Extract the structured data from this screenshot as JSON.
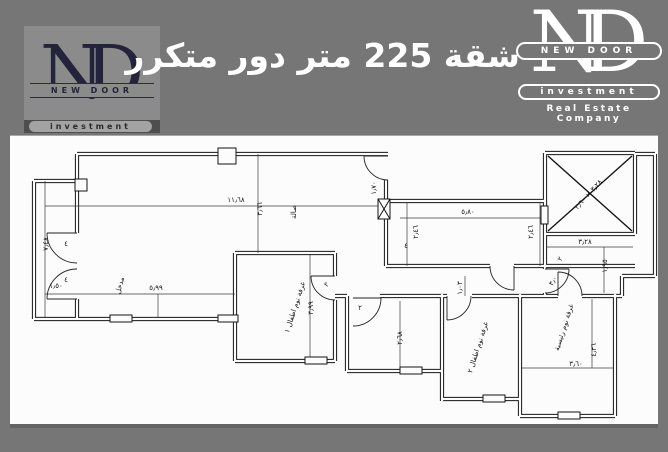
{
  "header": {
    "title": "شقة 225 متر دور متكرر"
  },
  "logo_left": {
    "monogram_n": "N",
    "monogram_d": "D",
    "band": "NEW DOOR",
    "pill": "investment"
  },
  "logo_right": {
    "monogram_n": "N",
    "monogram_d": "D",
    "band": "NEW DOOR",
    "pill": "investment",
    "tagline": "Real Estate Company"
  },
  "colors": {
    "background": "#767676",
    "panel": "#fcfcfc",
    "logo_left_box": "#8b8b8b",
    "logo_left_ink": "#23233b",
    "logo_left_dark_band": "#4e4e4e",
    "logo_right_ink": "#ffffff",
    "plan_line": "#151515",
    "title_text": "#ffffff"
  },
  "plan": {
    "annotations": [
      {
        "text": "١١٫٦٨",
        "x": 226,
        "y": 66,
        "rot": 0
      },
      {
        "text": "٣٫٦٦",
        "x": 252,
        "y": 73,
        "rot": -90
      },
      {
        "text": "صالة",
        "x": 286,
        "y": 76,
        "rot": -90
      },
      {
        "text": "٧٫٤٨",
        "x": 38,
        "y": 108,
        "rot": -90
      },
      {
        "text": "١٫٥٠",
        "x": 46,
        "y": 152,
        "rot": 0
      },
      {
        "text": "٥٫٩٩",
        "x": 146,
        "y": 154,
        "rot": 0
      },
      {
        "text": "مدخل",
        "x": 112,
        "y": 150,
        "rot": -75,
        "size": 6
      },
      {
        "text": "٥٫٨٠",
        "x": 458,
        "y": 78,
        "rot": 0
      },
      {
        "text": "٢٫٤٦",
        "x": 408,
        "y": 96,
        "rot": -90
      },
      {
        "text": "٢٫٤٦",
        "x": 523,
        "y": 96,
        "rot": -90
      },
      {
        "text": "٤",
        "x": 396,
        "y": 112,
        "rot": 0,
        "size": 6
      },
      {
        "text": "١٫٧٠",
        "x": 366,
        "y": 52,
        "rot": -90,
        "size": 5.5
      },
      {
        "text": "٣٫٢٨ × ٣٫٦٠",
        "x": 580,
        "y": 60,
        "rot": -48,
        "size": 6.5
      },
      {
        "text": "٣٫٢٨",
        "x": 575,
        "y": 108,
        "rot": 0
      },
      {
        "text": "١٫٩٥",
        "x": 597,
        "y": 130,
        "rot": -90
      },
      {
        "text": "٣٫٠",
        "x": 545,
        "y": 146,
        "rot": -60,
        "size": 6
      },
      {
        "text": "٢",
        "x": 552,
        "y": 124,
        "rot": -60,
        "size": 6
      },
      {
        "text": "٣٫٩٩",
        "x": 303,
        "y": 172,
        "rot": -90
      },
      {
        "text": "غرفة نوم اطفال ١",
        "x": 287,
        "y": 172,
        "rot": -72,
        "size": 6
      },
      {
        "text": "٢٫٦٨",
        "x": 392,
        "y": 202,
        "rot": -90
      },
      {
        "text": "٢",
        "x": 350,
        "y": 174,
        "rot": 0,
        "size": 6
      },
      {
        "text": "٢",
        "x": 318,
        "y": 150,
        "rot": -45,
        "size": 6
      },
      {
        "text": "١٫٠٣",
        "x": 452,
        "y": 152,
        "rot": -90,
        "size": 6
      },
      {
        "text": "غرفة نوم اطفال ٢",
        "x": 470,
        "y": 212,
        "rot": -72,
        "size": 6
      },
      {
        "text": "غرفة نوم رئيسية",
        "x": 556,
        "y": 192,
        "rot": -72,
        "size": 6
      },
      {
        "text": "٤٫٣٦",
        "x": 586,
        "y": 214,
        "rot": -90
      },
      {
        "text": "٣٫٦٠",
        "x": 566,
        "y": 230,
        "rot": 0
      },
      {
        "text": "٤",
        "x": 56,
        "y": 110,
        "rot": 0,
        "size": 6
      },
      {
        "text": "٤",
        "x": 56,
        "y": 146,
        "rot": 0,
        "size": 6
      }
    ]
  }
}
